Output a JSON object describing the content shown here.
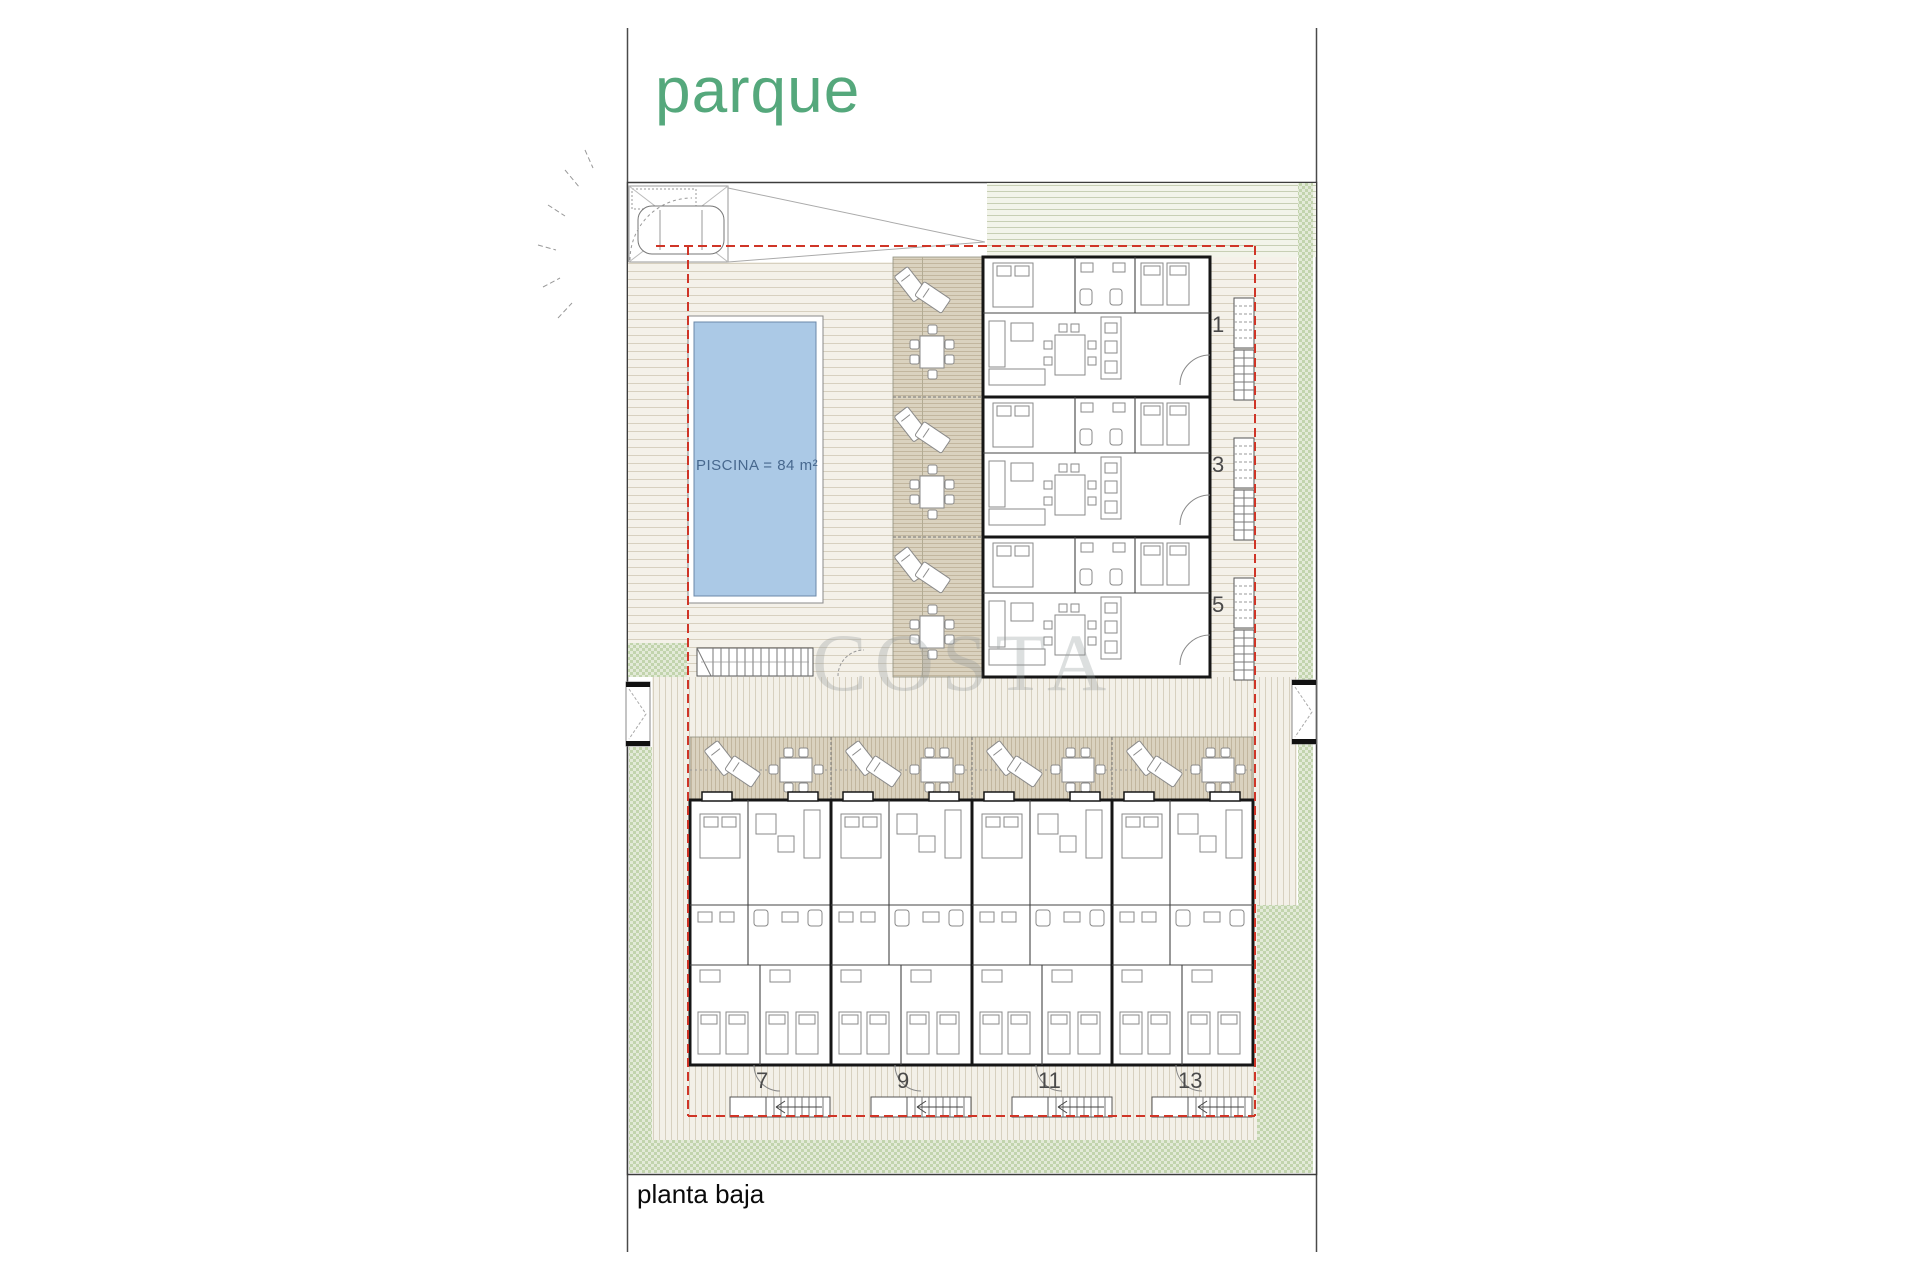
{
  "labels": {
    "park": "parque",
    "floor": "planta baja"
  },
  "pool": {
    "label": "PISCINA = 84 m²"
  },
  "watermark": {
    "text": "COSTA"
  },
  "upper_units": [
    {
      "number": "1"
    },
    {
      "number": "3"
    },
    {
      "number": "5"
    }
  ],
  "lower_units": [
    {
      "number": "7"
    },
    {
      "number": "9"
    },
    {
      "number": "11"
    },
    {
      "number": "13"
    }
  ],
  "colors": {
    "park_green": "#55a87c",
    "pool_fill": "#abc9e6",
    "pool_border": "#6b88a8",
    "pool_text": "#47688e",
    "boundary_red": "#cf3527",
    "grass_light": "#e3ead8",
    "grass_dark": "#c2d4ad",
    "deck_bg": "#f4f1e9",
    "deck_line": "#d7d0bf",
    "terrace_bg": "#dad2bf",
    "terrace_line": "#c2b69e",
    "wall": "#161616"
  }
}
